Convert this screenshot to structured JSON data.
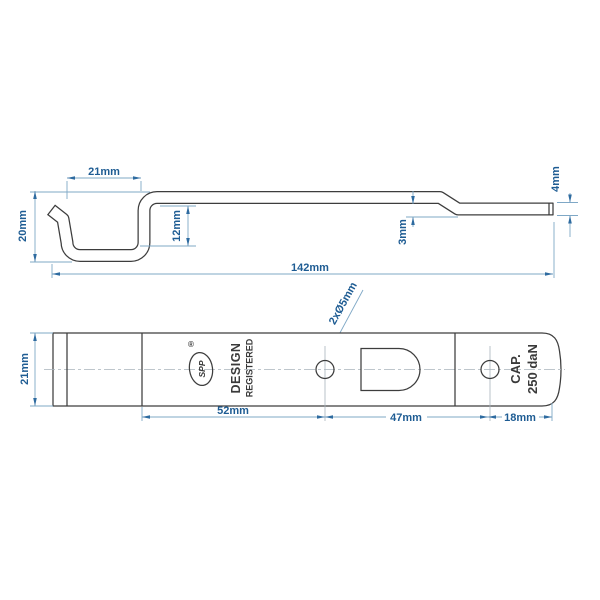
{
  "drawing_title": "latch-bar-technical-drawing",
  "colors": {
    "outline": "#3d3d3d",
    "dimension_line": "#7fa8c6",
    "dimension_text": "#1e5c93",
    "arrow": "#2e6ba0",
    "centerline": "#a9b4bc",
    "background": "#ffffff"
  },
  "side_view": {
    "dim_hook_opening": "21mm",
    "dim_hook_depth": "20mm",
    "dim_inner_height": "12mm",
    "dim_step_offset": "3mm",
    "dim_end_thickness": "4mm",
    "dim_total_length": "142mm"
  },
  "plan_view": {
    "dim_width": "21mm",
    "dim_bend_to_hole1": "52mm",
    "dim_hole_spacing": "47mm",
    "dim_hole_to_end": "18mm",
    "holes_label": "2xØ5mm",
    "design_registered_line1": "DESIGN",
    "design_registered_line2": "REGISTERED",
    "capacity_line1": "CAP.",
    "capacity_line2": "250 daN",
    "logo_text": "SPP",
    "registered_symbol": "®"
  }
}
